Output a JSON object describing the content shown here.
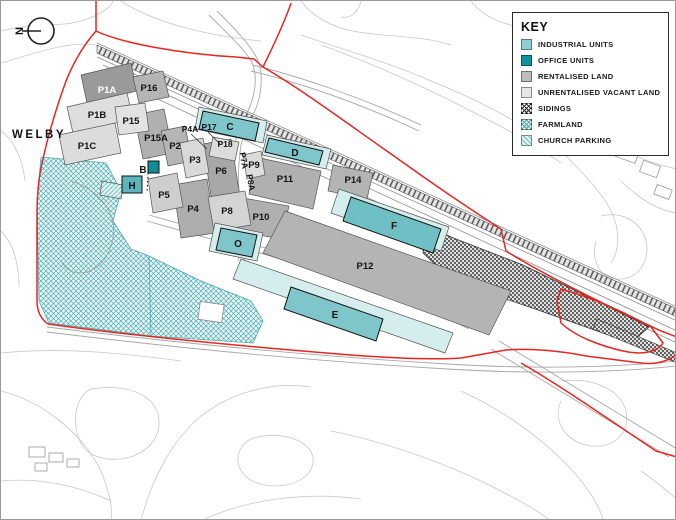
{
  "map": {
    "north_label": "N",
    "place_label": "WELBY",
    "plot_labels": {
      "p1a": "P1A",
      "p1b": "P1B",
      "p1c": "P1C",
      "p2": "P2",
      "p3": "P3",
      "p4": "P4",
      "p4a": "P4A",
      "p5": "P5",
      "p6": "P6",
      "p7a": "P7A",
      "p8": "P8",
      "p8a": "P8A",
      "p9": "P9",
      "p10": "P10",
      "p11": "P11",
      "p12": "P12",
      "p14": "P14",
      "p15": "P15",
      "p15a": "P15A",
      "p16": "P16",
      "p17": "P17",
      "p18": "P18"
    },
    "building_labels": {
      "b": "B",
      "c": "C",
      "d": "D",
      "e": "E",
      "f": "F",
      "h": "H",
      "o": "O"
    }
  },
  "key": {
    "title": "KEY",
    "items": [
      {
        "label": "INDUSTRIAL UNITS",
        "swatch": "industrial-units-swatch",
        "color": "#8ecdd2"
      },
      {
        "label": "OFFICE UNITS",
        "swatch": "office-units-swatch",
        "color": "#11919a"
      },
      {
        "label": "RENTALISED LAND",
        "swatch": "rentalised-land-swatch",
        "color": "#bcbcbc"
      },
      {
        "label": "UNRENTALISED VACANT LAND",
        "swatch": "unrentalised-vacant-land-swatch",
        "color": "#e6e6e6"
      },
      {
        "label": "SIDINGS",
        "swatch": "sidings-swatch",
        "color": "#2a2a2a"
      },
      {
        "label": "FARMLAND",
        "swatch": "farmland-swatch",
        "color": "#4aacb2"
      },
      {
        "label": "CHURCH PARKING",
        "swatch": "church-parking-swatch",
        "color": "#6fc0c6"
      }
    ]
  },
  "colors": {
    "boundary_red": "#e8251f",
    "industrial_units": "#7fc6cb",
    "office_units": "#0e8d95",
    "rentalised_land": "#b4b4b4",
    "unrentalised_vacant_land": "#dedede",
    "industrial_land_strip": "#d6edee"
  }
}
